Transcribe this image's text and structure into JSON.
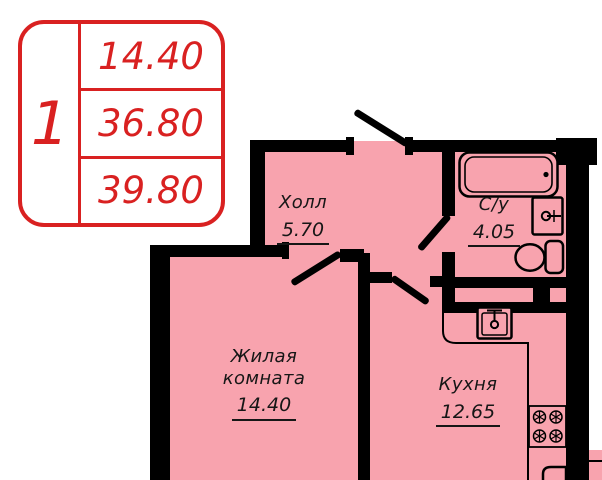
{
  "legend": {
    "rooms_count": "1",
    "row1": "14.40",
    "row2": "36.80",
    "row3": "39.80"
  },
  "rooms": {
    "hall": {
      "name": "Холл",
      "area": "5.70"
    },
    "bathroom": {
      "name": "С/у",
      "area": "4.05"
    },
    "living": {
      "name": "Жилая комната",
      "area": "14.40"
    },
    "kitchen": {
      "name": "Кухня",
      "area": "12.65"
    }
  },
  "fixtures": [
    "bathtub",
    "bathroom-sink",
    "toilet",
    "kitchen-sink",
    "stove-4-burners",
    "fridge-partial"
  ],
  "colors": {
    "wall": "#000000",
    "room_fill": "#F8A3AE",
    "legend_red": "#D92121",
    "label_text": "#161616",
    "background": "#FFFFFF"
  }
}
